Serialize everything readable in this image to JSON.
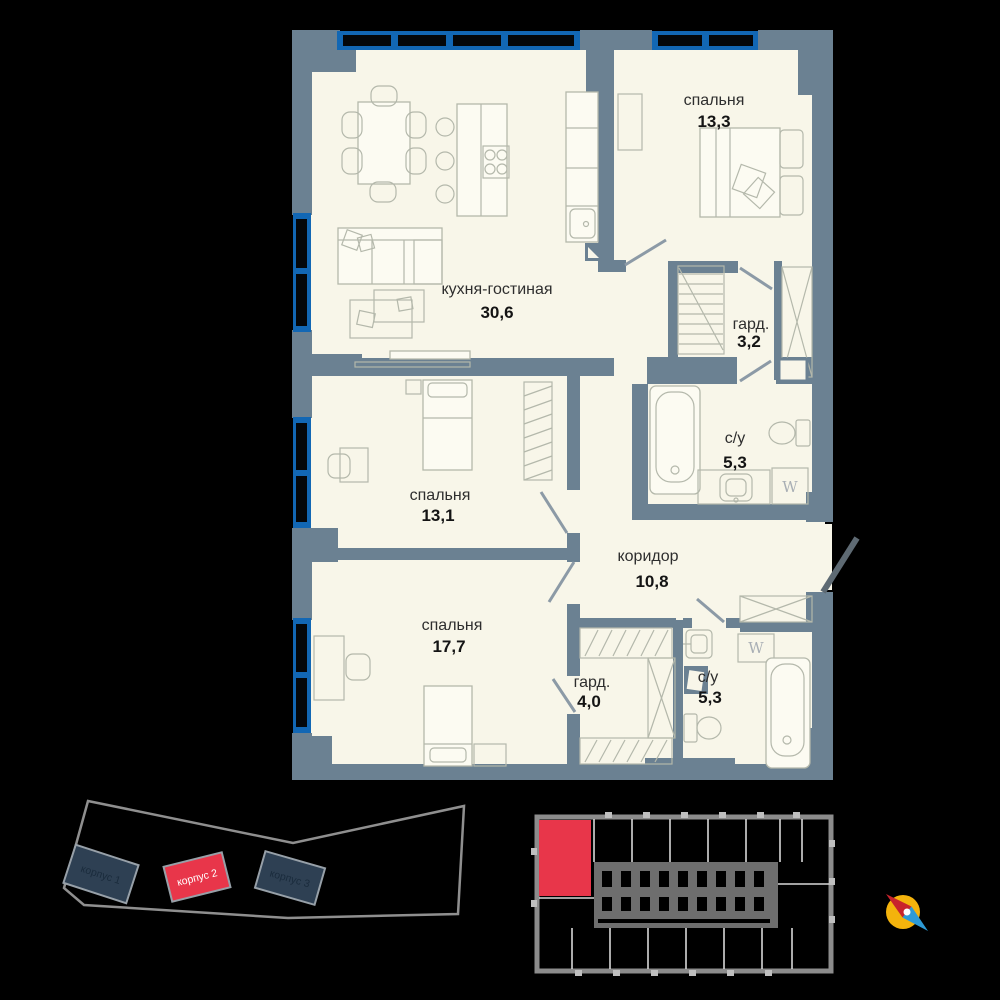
{
  "plan": {
    "rooms": [
      {
        "id": "kitchen-living",
        "name": "кухня-гостиная",
        "area": "30,6"
      },
      {
        "id": "bedroom-1",
        "name": "спальня",
        "area": "13,3"
      },
      {
        "id": "wardrobe-1",
        "name": "гард.",
        "area": "3,2"
      },
      {
        "id": "bathroom-1",
        "name": "с/у",
        "area": "5,3"
      },
      {
        "id": "bedroom-2",
        "name": "спальня",
        "area": "13,1"
      },
      {
        "id": "corridor",
        "name": "коридор",
        "area": "10,8"
      },
      {
        "id": "bedroom-3",
        "name": "спальня",
        "area": "17,7"
      },
      {
        "id": "wardrobe-2",
        "name": "гард.",
        "area": "4,0"
      },
      {
        "id": "bathroom-2",
        "name": "с/у",
        "area": "5,3"
      }
    ],
    "washer_labels": [
      "W",
      "W"
    ]
  },
  "site_plan": {
    "buildings": [
      {
        "label": "корпус 1",
        "highlighted": false
      },
      {
        "label": "корпус 2",
        "highlighted": true
      },
      {
        "label": "корпус 3",
        "highlighted": false
      }
    ]
  },
  "floor_overview": {
    "selected_unit": "top-left-corner-apartment"
  },
  "icons": {
    "compass": "compass-rose-icon"
  },
  "colors": {
    "wall": "#6B8192",
    "window": "#1267B4",
    "floor": "#F8F6E9",
    "accent_red": "#E8364A",
    "compass_yellow": "#F4B30C",
    "compass_red": "#C8232C",
    "compass_blue": "#2D9AD6",
    "background": "#000000"
  }
}
